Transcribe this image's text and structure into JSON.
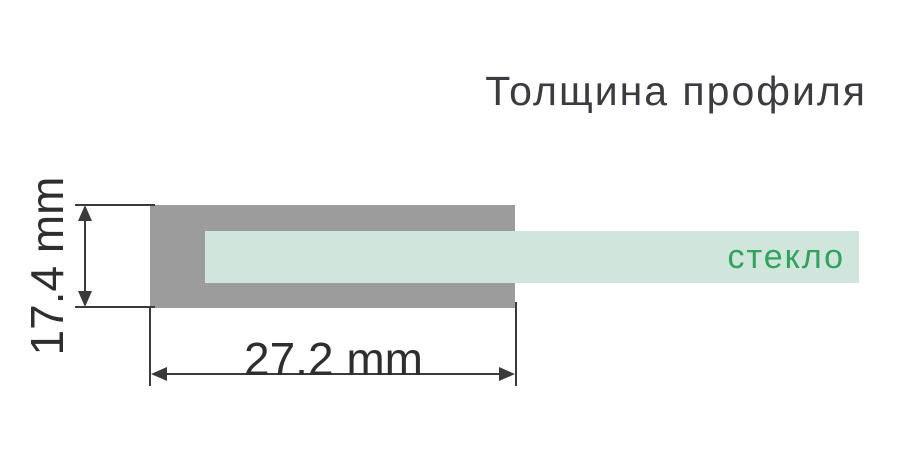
{
  "title": "Толщина профиля",
  "diagram": {
    "glass_label": "стекло",
    "height_dimension": "17.4 mm",
    "width_dimension": "27.2 mm"
  },
  "colors": {
    "profile_gray": "#9c9c9c",
    "glass_mint": "#d0e5dc",
    "glass_label_green": "#2ea45c",
    "dimension_line": "#3a3a3a",
    "dimension_text": "#2e2e2e",
    "title_text": "#3b3b40",
    "background": "#ffffff"
  }
}
